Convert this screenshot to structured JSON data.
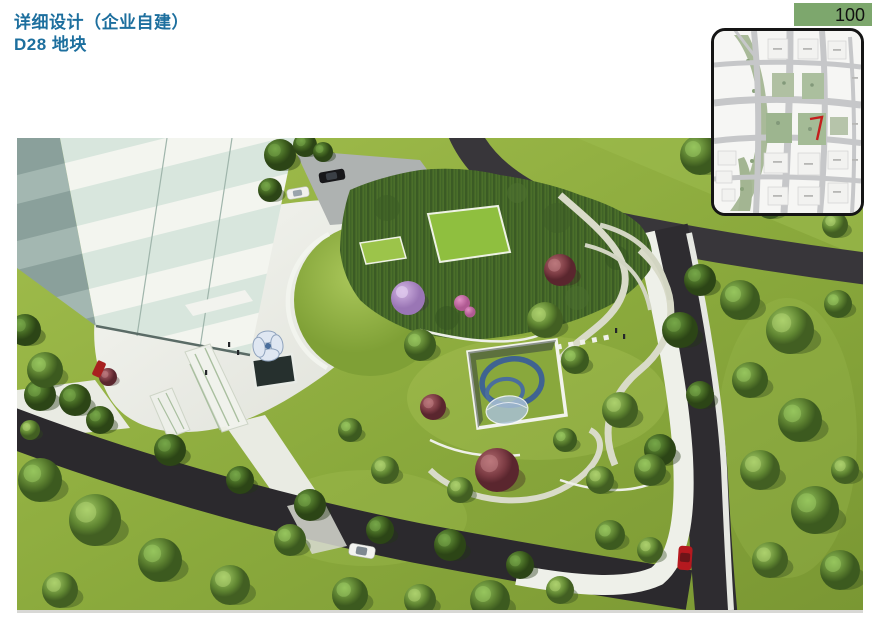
{
  "header": {
    "title_line1": "详细设计（企业自建）",
    "title_line2": "D28 地块"
  },
  "page_number": {
    "value": "100"
  },
  "colors": {
    "title_text": "#1d6f9e",
    "page_tab_bg": "#7da76d",
    "page_number_text": "#111111",
    "map_border": "#151515",
    "map_road_gray": "#c6c7c9",
    "map_park_green": "#a9ba99",
    "site_marker_red": "#c41e1c",
    "lawn_green": "#8fae3e",
    "road_asphalt": "#2e2c30",
    "pavement_white": "#eff0ea",
    "building_mint": "#d8e6dd",
    "building_white": "#f3f5ef",
    "spiral_blue": "#3f6391",
    "accent_tree_maroon": "#7a3a42",
    "accent_tree_purple": "#9a76b5"
  },
  "rendering": {
    "alt": "Aerial perspective rendering of D28 plot: striped mint office tower with white plaza, bamboo grove with green roof pavilion, sunken courtyard with blue spiral ramp, curved garden paths, perimeter asphalt roads with cars"
  },
  "map_inset": {
    "alt": "Location key map with road grid, riverside park band and red marker on the D28 site"
  }
}
